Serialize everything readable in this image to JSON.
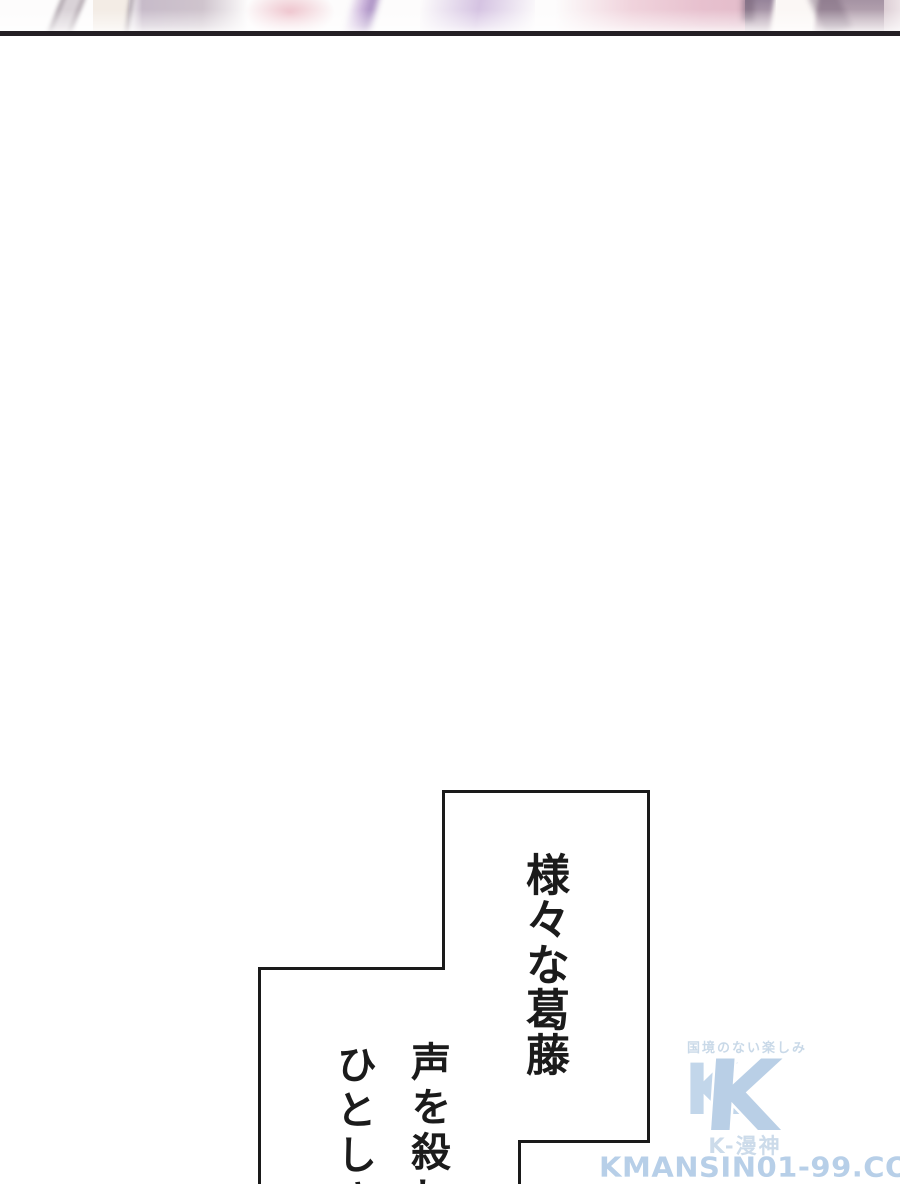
{
  "page": {
    "background": "#ffffff",
    "panel_border_color": "#241f24"
  },
  "top_panel": {
    "description": "bottom sliver of a pastel color manga panel",
    "palette": [
      "#c7bbc9",
      "#eec3cc",
      "#cdb6dc",
      "#d5c3e2",
      "#e7c0ce",
      "#96849a",
      "#a593a3",
      "#fbf7f5"
    ]
  },
  "speech_bubbles": {
    "outline_color": "#1a1a1a",
    "fill": "#ffffff",
    "bubble_main_text": "様々な葛藤",
    "bubble_lower_col_right": "声を殺し",
    "bubble_lower_col_left": "ひとしき"
  },
  "watermark": {
    "tagline": "国境のない楽しみ",
    "logo_letter_small": "K",
    "logo_letter": "K",
    "site_name": "K-漫神",
    "site_url": "KMANSIN01-99.COM",
    "color": "#b9cfe4"
  }
}
